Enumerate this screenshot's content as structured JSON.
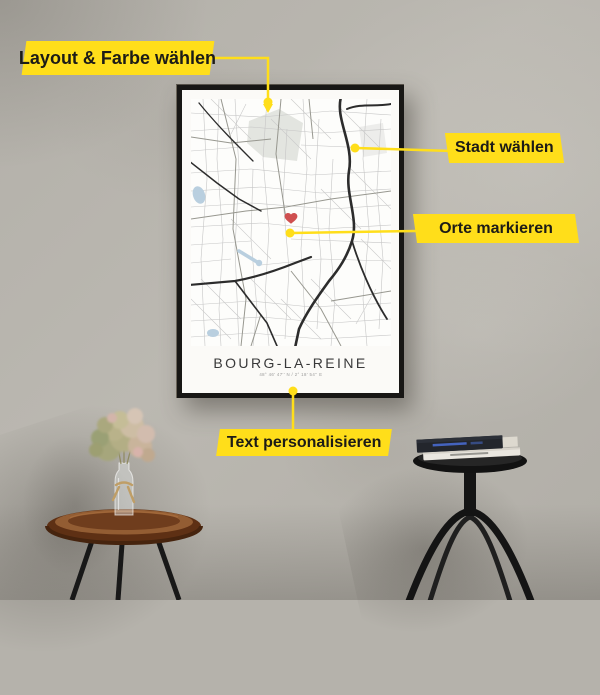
{
  "callouts": [
    {
      "label": "Layout & Farbe wählen"
    },
    {
      "label": "Stadt wählen"
    },
    {
      "label": "Orte markieren"
    },
    {
      "label": "Text personalisieren"
    }
  ],
  "poster": {
    "title": "BOURG-LA-REINE",
    "coordinates": "48° 46' 47'' N / 2° 18' 54'' E"
  },
  "colors": {
    "accent_yellow": "#FFDE1A",
    "heart_red": "#cf5050",
    "water_blue": "#b9cfdf",
    "park_grey": "#e3e5e0",
    "frame_black": "#181715",
    "wall_grey": "#b5b2ab",
    "wood_brown": "#8a5531"
  },
  "icons": {
    "location_pin": "location-pin-icon",
    "heart": "heart-icon",
    "dot": "connector-dot"
  }
}
